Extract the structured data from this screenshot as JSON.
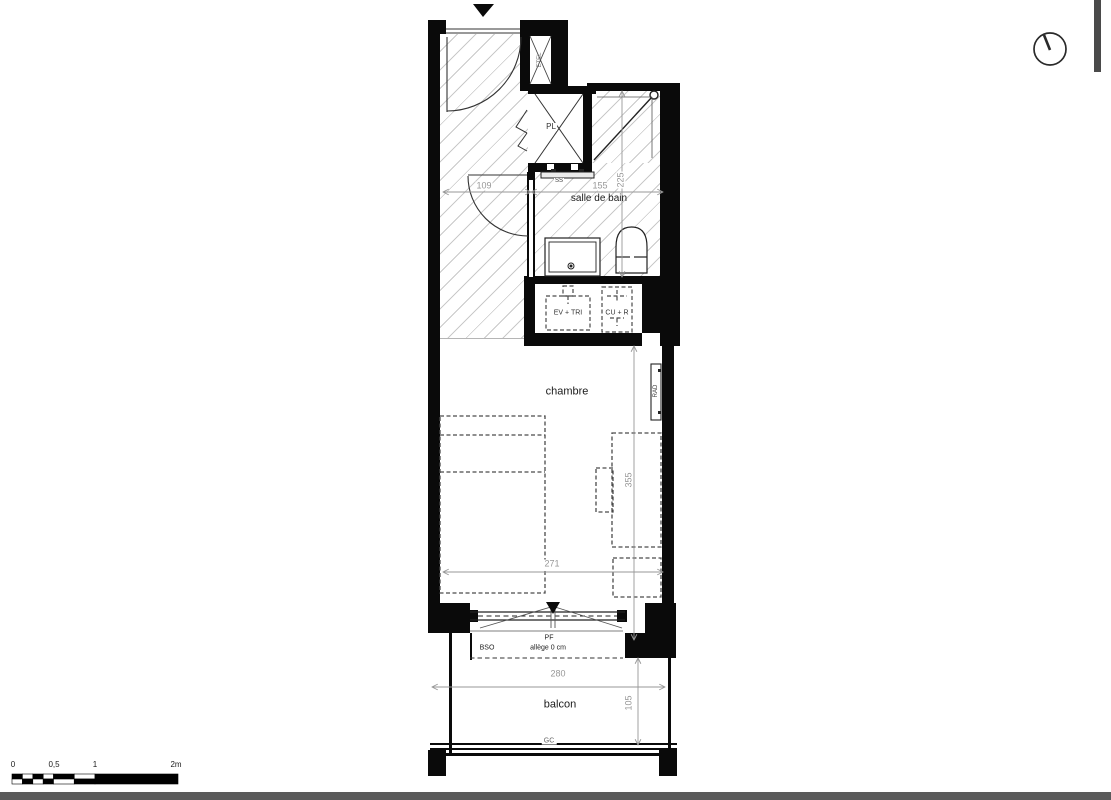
{
  "rooms": {
    "bathroom": "salle de bain",
    "bedroom": "chambre",
    "balcony": "balcon"
  },
  "fixtures": {
    "closet": "PL",
    "shaft": "ETEL",
    "towel_dryer": "SS",
    "radiator": "RAD",
    "sink_unit": "EV + TRI",
    "cooktop_fridge": "CU + R",
    "french_window": "PF",
    "blind": "BSO",
    "sill": "allège 0 cm",
    "railing": "GC"
  },
  "dimensions": {
    "hall_width": "109",
    "bath_width": "155",
    "bath_depth": "225",
    "room_width": "271",
    "room_depth": "355",
    "balcony_width": "280",
    "balcony_depth": "105"
  },
  "scale_bar": {
    "zero": "0",
    "half": "0,5",
    "one": "1",
    "two": "2m"
  },
  "colors": {
    "wall": "#0a0a0a",
    "hatch_line": "#c9c9c9",
    "dimension": "#979797",
    "text": "#1a1a1a",
    "page_band": "#5a5a5a"
  }
}
